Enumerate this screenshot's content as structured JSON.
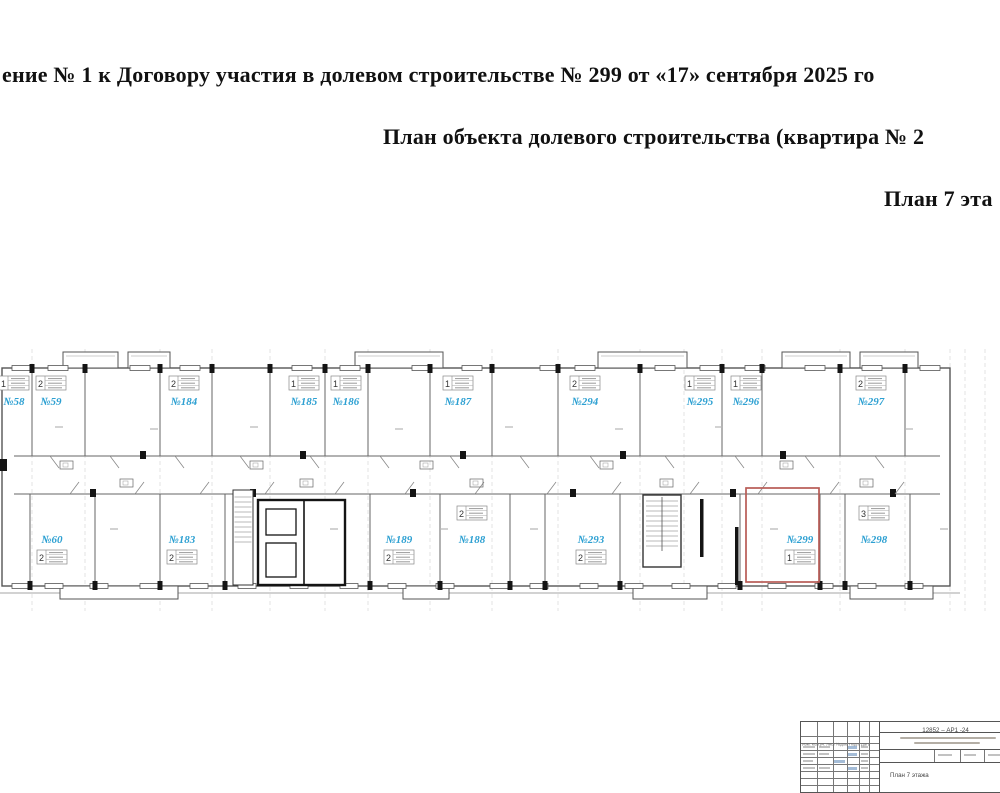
{
  "document": {
    "line1": "ение № 1 к Договору участия в долевом строительстве № 299 от «17» сентября 2025 го",
    "line2": "План объекта долевого строительства (квартира № 2",
    "line3": "План 7 эта"
  },
  "floor_plan": {
    "label_color": "#2da0d2",
    "highlight_color": "#b85b55",
    "highlighted_apartment": "№299",
    "apartments": [
      {
        "label": "№58",
        "rooms": "1",
        "row": "top",
        "x": 14,
        "table": "above"
      },
      {
        "label": "№59",
        "rooms": "2",
        "row": "top",
        "x": 51,
        "table": "above"
      },
      {
        "label": "№184",
        "rooms": "2",
        "row": "top",
        "x": 184,
        "table": "above"
      },
      {
        "label": "№185",
        "rooms": "1",
        "row": "top",
        "x": 304,
        "table": "above"
      },
      {
        "label": "№186",
        "rooms": "1",
        "row": "top",
        "x": 346,
        "table": "above"
      },
      {
        "label": "№187",
        "rooms": "1",
        "row": "top",
        "x": 458,
        "table": "above"
      },
      {
        "label": "№294",
        "rooms": "2",
        "row": "top",
        "x": 585,
        "table": "above"
      },
      {
        "label": "№295",
        "rooms": "1",
        "row": "top",
        "x": 700,
        "table": "above"
      },
      {
        "label": "№296",
        "rooms": "1",
        "row": "top",
        "x": 746,
        "table": "above"
      },
      {
        "label": "№297",
        "rooms": "2",
        "row": "top",
        "x": 871,
        "table": "above"
      },
      {
        "label": "№60",
        "rooms": "2",
        "row": "bottom",
        "x": 52,
        "table": "below"
      },
      {
        "label": "№183",
        "rooms": "2",
        "row": "bottom",
        "x": 182,
        "table": "below"
      },
      {
        "label": "№189",
        "rooms": "2",
        "row": "bottom",
        "x": 399,
        "table": "below"
      },
      {
        "label": "№188",
        "rooms": "2",
        "row": "bottom",
        "x": 472,
        "table": "above2"
      },
      {
        "label": "№293",
        "rooms": "2",
        "row": "bottom",
        "x": 591,
        "table": "below"
      },
      {
        "label": "№299",
        "rooms": "1",
        "row": "bottom",
        "x": 800,
        "table": "below",
        "highlighted": true
      },
      {
        "label": "№298",
        "rooms": "3",
        "row": "bottom",
        "x": 874,
        "table": "above2"
      }
    ]
  },
  "stamp": {
    "doc_code": "12852 – АР1 -24",
    "sheet_title": "План 7 этажа",
    "header_row": "Изм. Кол.уч. Лист №док. Подп. Дата",
    "logo_text": "ПОР"
  }
}
